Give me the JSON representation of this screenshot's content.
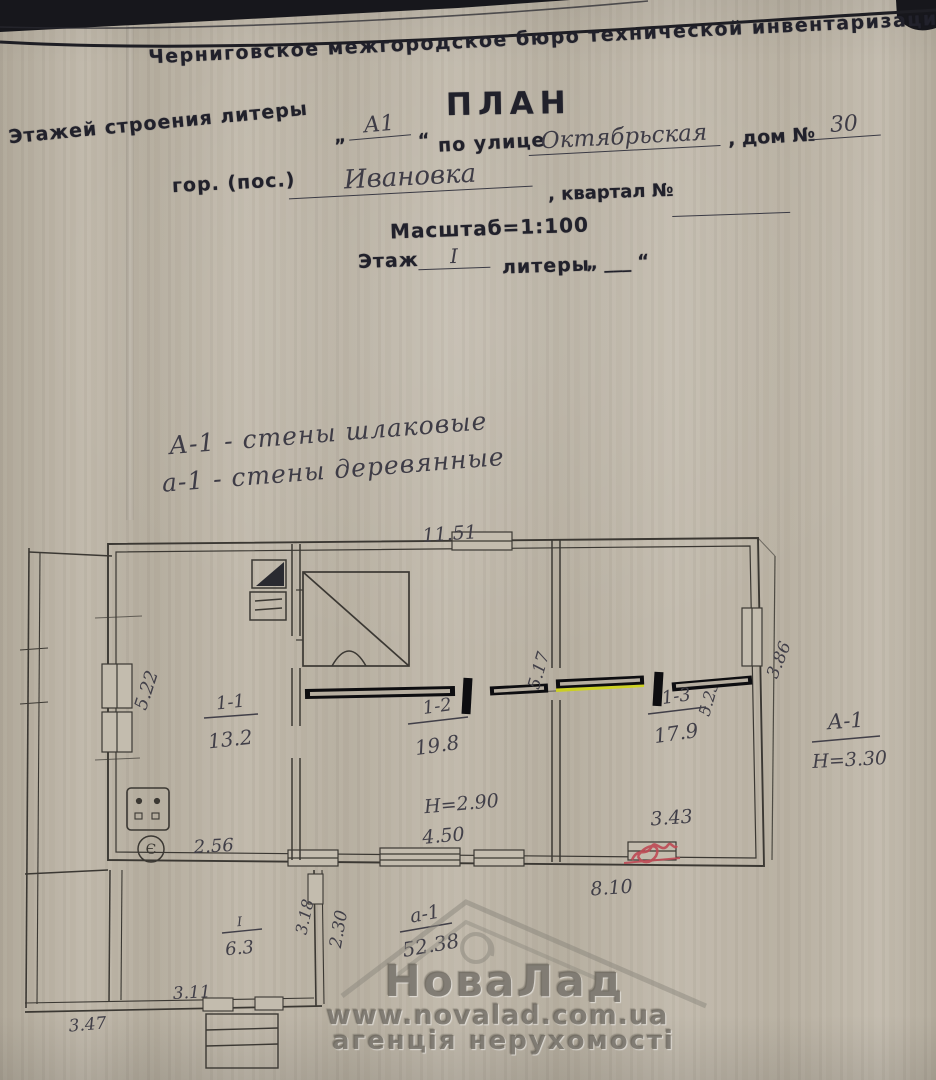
{
  "header": {
    "bureau": "Черниговское межгородское бюро технической инвентаризации",
    "title": "ПЛАН",
    "line1_label": "Этажей строения литеры",
    "open_quote": "„",
    "close_quote": "“",
    "litera_value": "А1",
    "street_label": "по улице",
    "street_value": "Октябрьская",
    "house_label": ", дом №",
    "house_value": "30",
    "city_label": "гор. (пос.)",
    "city_value": "Ивановка",
    "block_label": ", квартал №",
    "scale_label": "Масштаб=1:100",
    "floor_label": "Этаж",
    "floor_value": "І",
    "litery_label": "литеры",
    "litery_blank": "„ ___ “"
  },
  "legend": {
    "line1": "А-1 - стены шлаковые",
    "line2": "а-1 - стены деревянные"
  },
  "plan": {
    "dim_top": "11.51",
    "room1_id": "1-1",
    "room1_area": "13.2",
    "room2_id": "1-2",
    "room2_area": "19.8",
    "room3_id": "1-3",
    "room3_area": "17.9",
    "height_note": "Н=2.90",
    "dim_bottom_room2": "4.50",
    "dim_bottom_room3": "3.43",
    "dim_bottom_main": "8.10",
    "dim_room1_width": "2.56",
    "dim_room1_depth": "5.22",
    "dim_room2_depth": "5.17",
    "dim_room3_depth": "5.23",
    "dim_right_outer": "3.86",
    "stove_mark": "Є",
    "note_litera": "А-1",
    "note_height": "Н=3.30",
    "porch_id": "І",
    "porch_area": "6.3",
    "porch_dim_depth": "3.18",
    "porch_dim_230": "2.30",
    "porch_dim_width_in": "3.11",
    "porch_dim_width_out": "3.47",
    "total_litera": "а-1",
    "total_area": "52.38"
  },
  "watermark": {
    "brand": "НоваЛад",
    "url": "www.novalad.com.ua",
    "tagline": "агенція нерухомості"
  },
  "colors": {
    "marker_black": "#0d0d10",
    "highlight_yellow": "#cfd41e",
    "correction_red": "#bf4a55",
    "ink": "#3b3833",
    "paper": "#bdb5a6"
  }
}
